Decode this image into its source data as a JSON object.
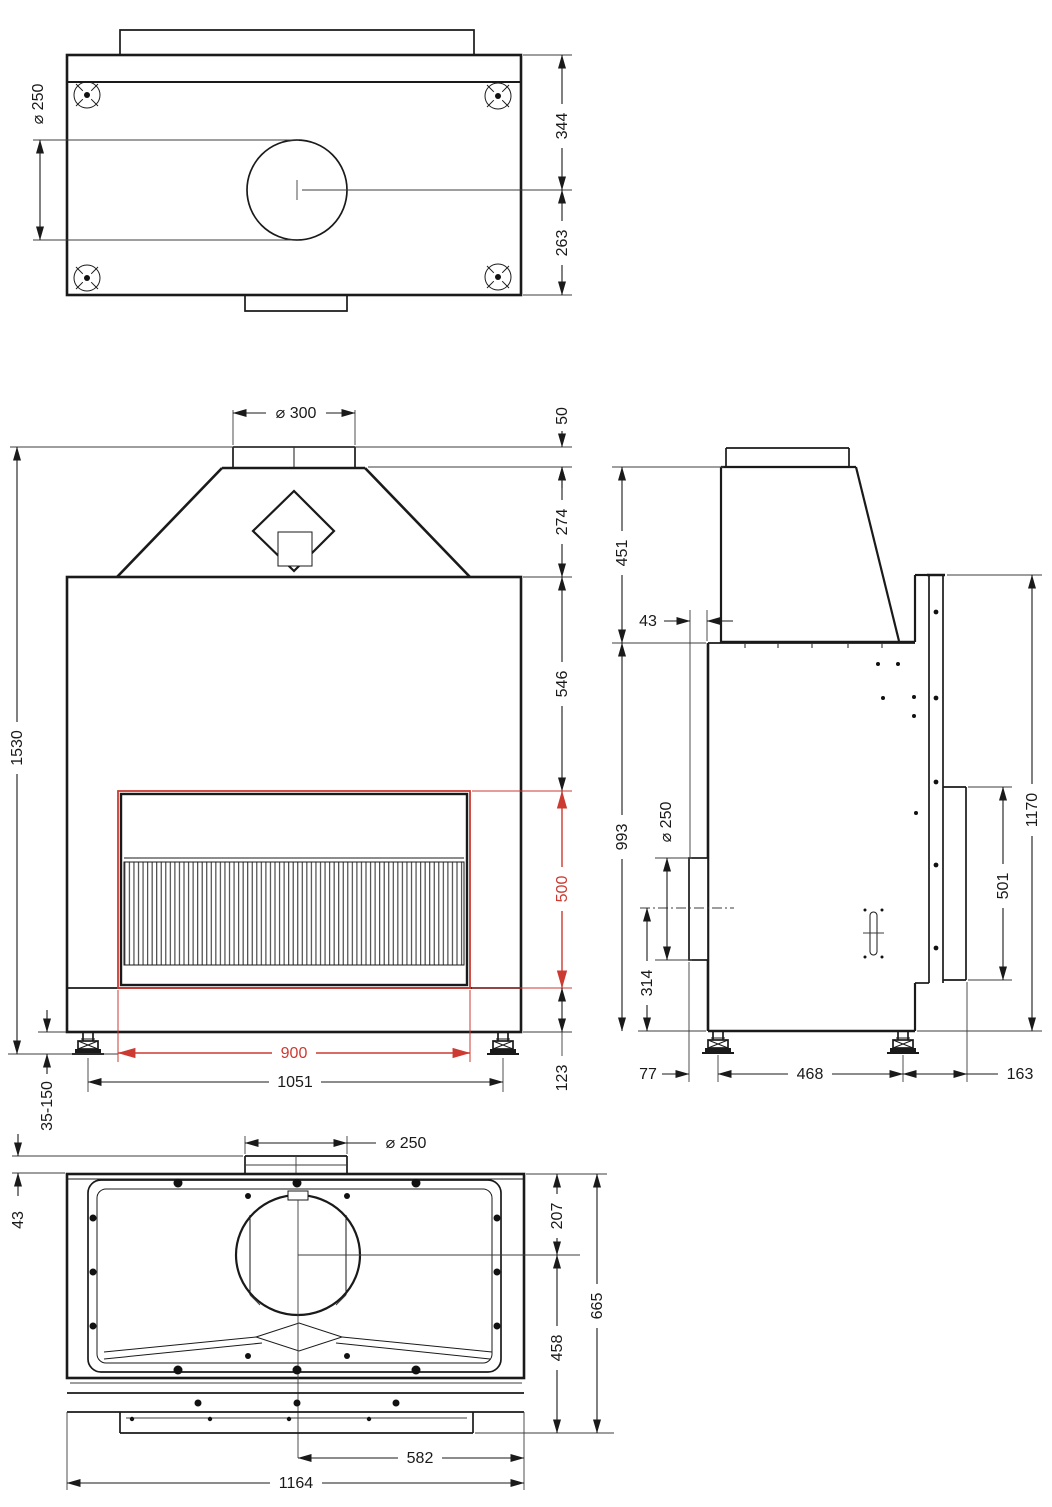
{
  "colors": {
    "line": "#1a1a1a",
    "dimension_highlight": "#cc3a31",
    "background": "#ffffff"
  },
  "top_view": {
    "flue_diameter": "⌀ 250",
    "top_edge_to_flue_center": "344",
    "flue_center_to_bottom_edge": "263"
  },
  "front_view": {
    "flue_diameter": "⌀ 300",
    "collar_height": "50",
    "hood_height": "274",
    "top_to_opening": "546",
    "opening_height": "500",
    "opening_width": "900",
    "total_height": "1530",
    "feet_spacing": "1051",
    "base_height": "123",
    "leg_adjust_range": "35-150"
  },
  "side_view": {
    "hood_height": "451",
    "rear_flue_offset": "43",
    "body_height": "993",
    "rear_flue_diameter": "⌀ 250",
    "rear_flue_center_height": "314",
    "front_height": "1170",
    "glass_panel_height": "501",
    "back_to_front_leg": "77",
    "leg_spacing": "468",
    "leg_to_front_edge": "163"
  },
  "bottom_view": {
    "flue_diameter": "⌀ 250",
    "collar_offset": "43",
    "top_to_flue_center": "207",
    "flue_center_to_base": "458",
    "total_depth": "665",
    "center_to_side": "582",
    "total_width": "1164"
  }
}
